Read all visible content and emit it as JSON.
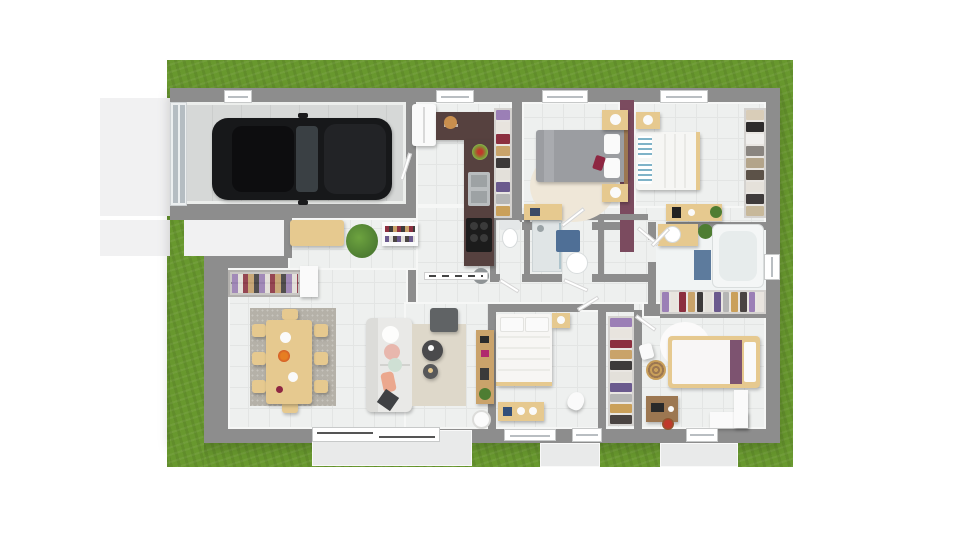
{
  "scene": {
    "name": "house-floor-plan-3d-top-view",
    "canvas_width": 960,
    "canvas_height": 540,
    "style": "architectural 3d rendering, top-down, on white background with lawn"
  },
  "colors": {
    "background": "#ffffff",
    "grass": "#68982e",
    "driveway": "#f1f1f2",
    "terrace": "#e9eaea",
    "wall": "#8d8d8d",
    "accent_wall": "#7b4b5f",
    "floor": "#eef0ef",
    "floor_line": "#e3e5e4",
    "garage_floor": "#d6d8d7",
    "counter": "#56413f",
    "wood": "#e6c98f",
    "wood_dark": "#9c7751",
    "car_body": "#17181a",
    "car_glass": "#3a4044",
    "sofa": "#e9e9e7",
    "rug_gray": "#b5b1a8",
    "rug_beige": "#ded8ca",
    "rug_cream": "#efe7d8",
    "bed_gray": "#9b9da1",
    "mat_blue": "#5d7b9d",
    "cabinet_blue": "#4f6f96",
    "plant": "#4e7d32",
    "white_furniture": "#fafafa",
    "steel": "#b9bdbf",
    "dark_table": "#4a4a4c"
  },
  "clothes_hanging": [
    "#9b7fb6",
    "#e8e4de",
    "#8c2f3f",
    "#c9a36a",
    "#3d3a3a",
    "#e3e0da",
    "#6b5a8e",
    "#b5b5b5",
    "#caa05a",
    "#4a4442"
  ],
  "clothes_folded": [
    "#d9cdb8",
    "#2e2c2c",
    "#f0efed",
    "#8a8580",
    "#b3a48a",
    "#5c5248",
    "#e5e1da",
    "#3f3b3b",
    "#c7b89a",
    "#777"
  ],
  "rooms": [
    {
      "name": "garage",
      "furniture": [
        "black-car",
        "sectional-garage-door",
        "side-door"
      ]
    },
    {
      "name": "entry-hall",
      "furniture": [
        "fridge",
        "coat-closet",
        "bench",
        "shoe-rack",
        "potted-plant"
      ]
    },
    {
      "name": "kitchen",
      "furniture": [
        "l-shaped-dark-counter",
        "double-sink",
        "cooktop",
        "fruit-bowls",
        "stool",
        "sliding-door-threshold"
      ]
    },
    {
      "name": "wc",
      "furniture": [
        "toilet"
      ]
    },
    {
      "name": "shower-room",
      "furniture": [
        "walk-in-shower",
        "washbasin",
        "blue-cabinet"
      ]
    },
    {
      "name": "bedroom-1",
      "furniture": [
        "double-bed-gray",
        "two-nightstands",
        "wall-desk",
        "round-cream-rug",
        "wardrobe-column"
      ]
    },
    {
      "name": "bedroom-2",
      "furniture": [
        "double-bed-white-blue-pillows",
        "nightstand",
        "desk-with-coffee-maker",
        "open-shelf-wardrobe",
        "plum-accent-wall"
      ]
    },
    {
      "name": "bathroom",
      "furniture": [
        "bathtub",
        "wood-vanity-washbasin",
        "blue-bath-mat",
        "plant",
        "window"
      ]
    },
    {
      "name": "dressing",
      "furniture": [
        "open-wardrobe-row"
      ]
    },
    {
      "name": "bedroom-3",
      "furniture": [
        "bed-purple-throw",
        "round-white-rug",
        "laundry-basket",
        "desk-with-laptop",
        "chair",
        "corner-bench",
        "red-flowers",
        "hall-wardrobe-column"
      ]
    },
    {
      "name": "bedroom-4",
      "furniture": [
        "bed-white",
        "nightstand",
        "desk",
        "chair",
        "window"
      ]
    },
    {
      "name": "living-dining",
      "furniture": [
        "wood-dining-table",
        "eight-chairs",
        "gray-rug",
        "white-sofa",
        "cushions",
        "two-round-coffee-tables",
        "gray-ottoman",
        "beige-rug",
        "shelf-unit",
        "floor-lamp",
        "sliding-bay-window"
      ]
    },
    {
      "name": "exterior",
      "furniture": [
        "lawn",
        "driveway",
        "terrace-slabs",
        "front-walkway"
      ]
    }
  ]
}
